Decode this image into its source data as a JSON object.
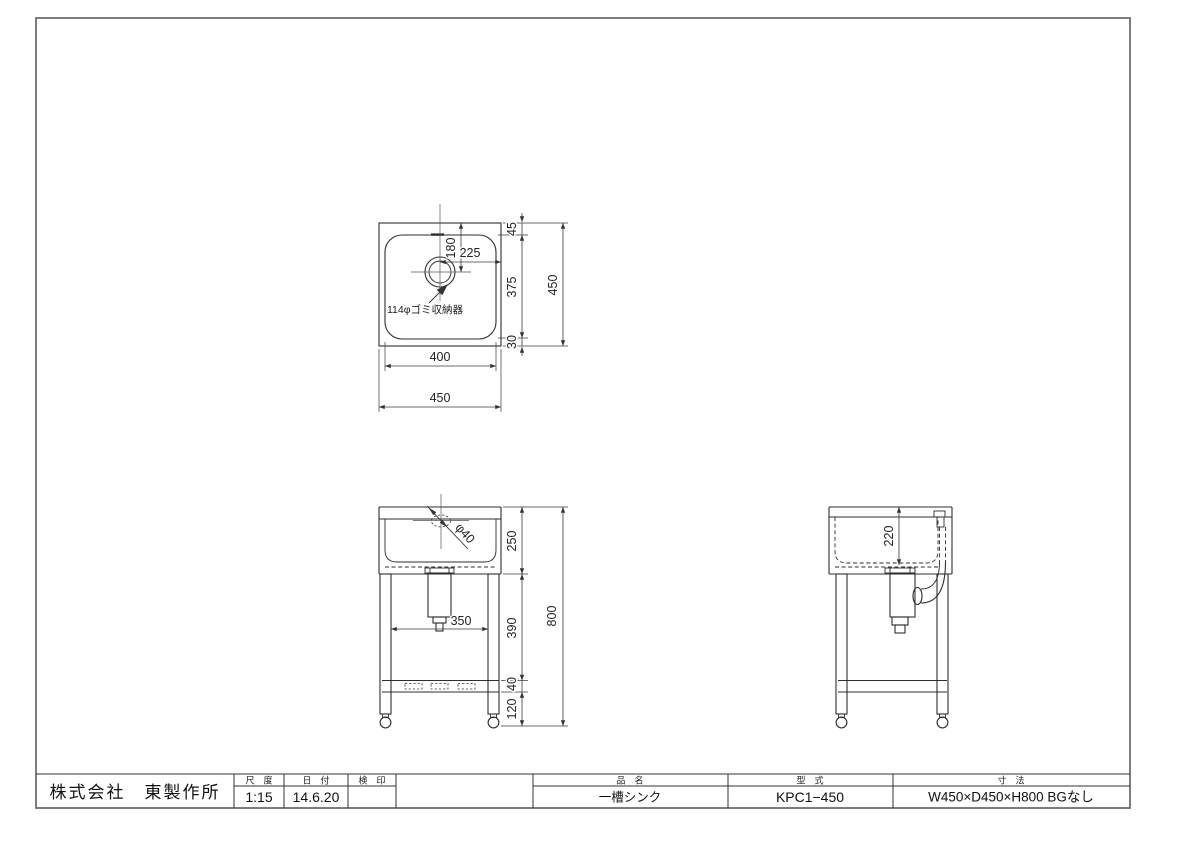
{
  "top_view": {
    "note": "114φゴミ収納器",
    "d180": "180",
    "d225": "225",
    "d45": "45",
    "d375": "375",
    "d30": "30",
    "d450_right": "450",
    "d400": "400",
    "d450_bottom": "450"
  },
  "front_view": {
    "phi40": "φ40",
    "d250": "250",
    "d390": "390",
    "d40": "40",
    "d120": "120",
    "d800": "800",
    "d350": "350"
  },
  "side_view": {
    "d220": "220"
  },
  "title_block": {
    "company": "株式会社　東製作所",
    "scale_label": "尺　度",
    "scale_value": "1:15",
    "date_label": "日　付",
    "date_value": "14.6.20",
    "stamp_label": "検　印",
    "stamp_value": "",
    "product_label": "品　名",
    "product_value": "一槽シンク",
    "model_label": "型　式",
    "model_value": "KPC1−450",
    "size_label": "寸　法",
    "size_value": "W450×D450×H800 BGなし"
  }
}
